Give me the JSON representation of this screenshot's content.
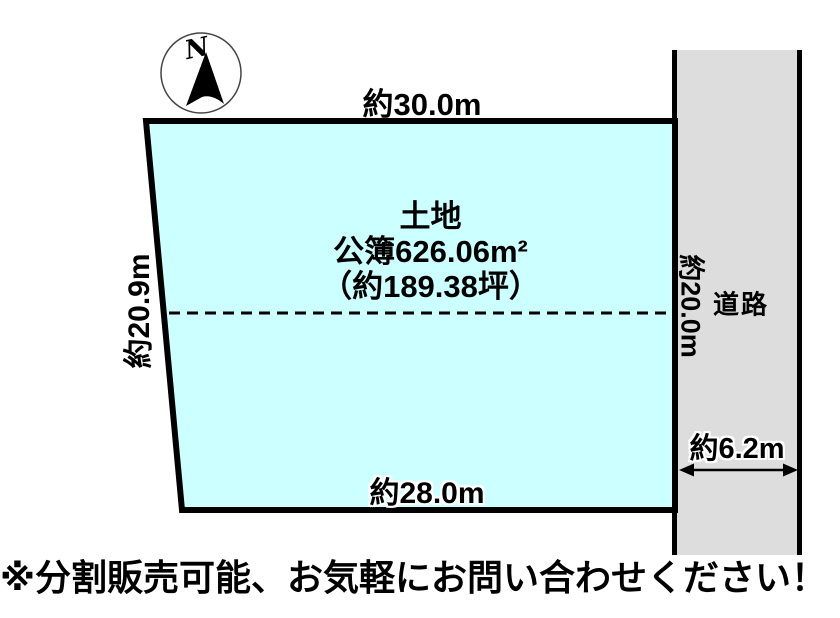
{
  "diagram": {
    "compass": {
      "north_label": "N"
    },
    "parcel": {
      "fill_color": "#CCFFFF",
      "title": "土地",
      "area_registered": "公簿626.06m²",
      "area_tsubo": "（約189.38坪）",
      "top_dimension": "約30.0m",
      "left_dimension": "約20.9m",
      "right_dimension": "約20.0m",
      "bottom_dimension": "約28.0m"
    },
    "road": {
      "fill_color": "#DDDDDD",
      "label": "道路",
      "width_dimension": "約6.2m"
    },
    "note": "※分割販売可能、お気軽にお問い合わせください！"
  }
}
